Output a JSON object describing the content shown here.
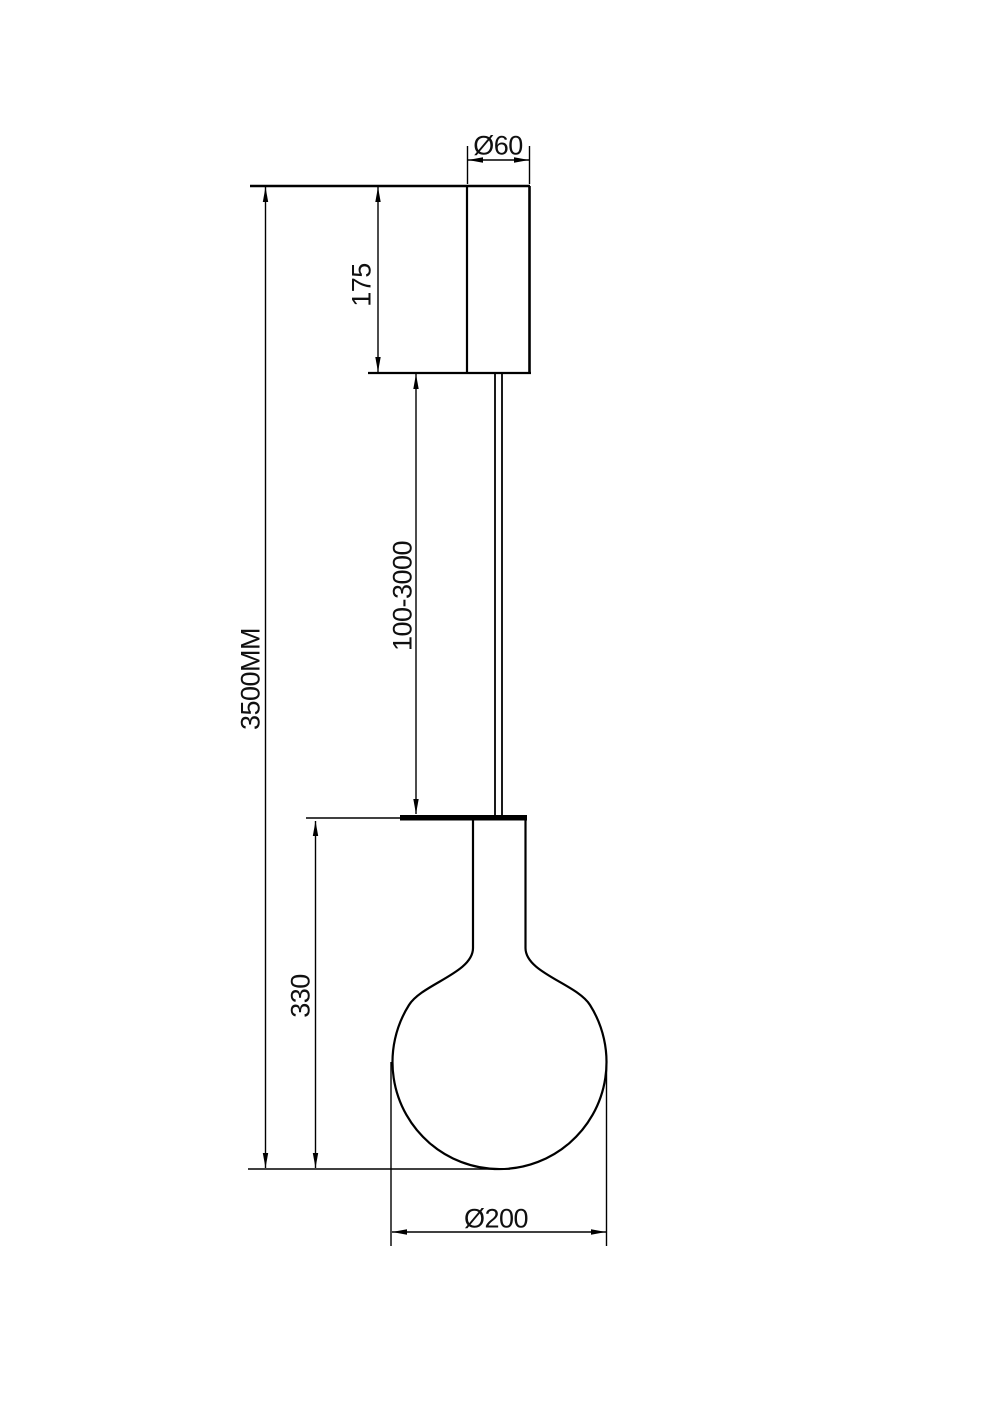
{
  "drawing": {
    "labels": {
      "canopy_diameter": "Ø60",
      "canopy_height": "175",
      "max_drop": "3500MM",
      "cable_range": "100-3000",
      "bulb_height": "330",
      "bulb_diameter": "Ø200"
    },
    "colors": {
      "line": "#000000",
      "background": "#ffffff"
    }
  }
}
